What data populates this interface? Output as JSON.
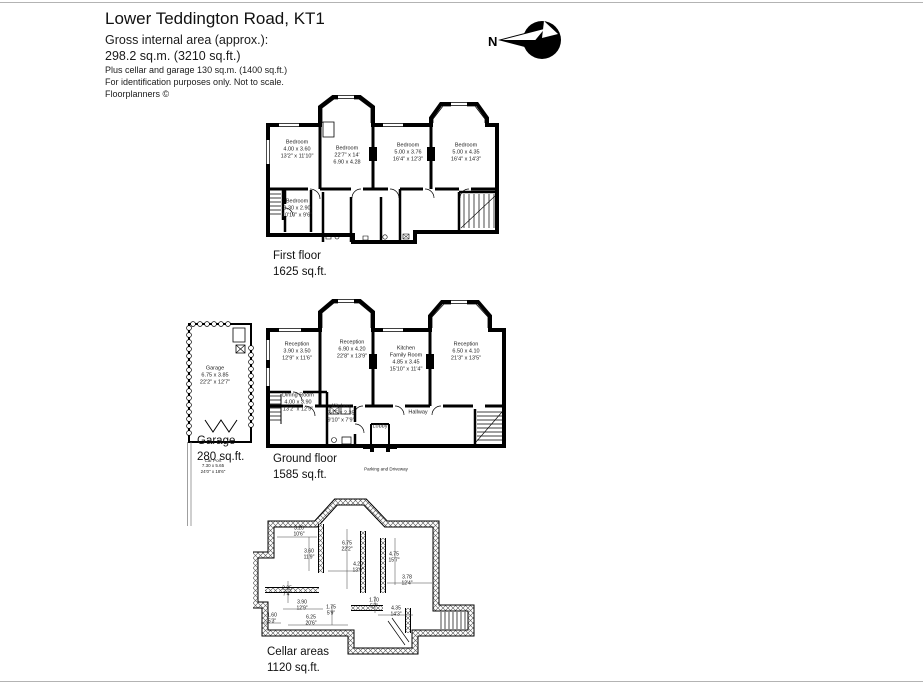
{
  "header": {
    "title": "Lower Teddington Road, KT1",
    "subtitle": "Gross internal area (approx.):",
    "area": "298.2 sq.m. (3210 sq.ft.)",
    "note_extra": "Plus cellar and garage 130 sq.m. (1400 sq.ft.)",
    "note_id": "For identification purposes only. Not to scale.",
    "note_brand": "Floorplanners ©"
  },
  "compass": {
    "label": "N"
  },
  "first_floor": {
    "label": "First floor",
    "area": "1625 sq.ft.",
    "rooms": [
      {
        "name": "Bedroom",
        "dim1": "4.00 x 3.60",
        "dim2": "13'2\" x 11'10\""
      },
      {
        "name": "Bedroom",
        "dim1": "22'7\" x 14'",
        "dim2": "6.90 x 4.28"
      },
      {
        "name": "Bedroom",
        "dim1": "5.00 x 3.76",
        "dim2": "16'4\" x 12'3\""
      },
      {
        "name": "Bedroom",
        "dim1": "5.00 x 4.35",
        "dim2": "16'4\" x 14'3\""
      },
      {
        "name": "Bedroom",
        "dim1": "3.30 x 2.90",
        "dim2": "10'10\" x 9'6\""
      }
    ]
  },
  "ground_floor": {
    "label": "Ground floor",
    "area": "1585 sq.ft.",
    "rooms": [
      {
        "name": "Reception",
        "dim1": "3.90 x 3.50",
        "dim2": "12'9\" x 11'6\""
      },
      {
        "name": "Reception",
        "dim1": "6.90 x 4.20",
        "dim2": "22'8\" x 13'9\""
      },
      {
        "name": "Kitchen Family Room",
        "dim1": "4.85 x 3.45",
        "dim2": "15'10\" x 11'4\""
      },
      {
        "name": "Reception",
        "dim1": "6.50 x 4.10",
        "dim2": "21'3\" x 13'5\""
      },
      {
        "name": "Dining Room",
        "dim1": "4.00 x 3.90",
        "dim2": "13'2\" x 12'9\""
      },
      {
        "name": "Kitchen",
        "dim1": "2.75 x 2.35",
        "dim2": "9'10\" x 7'9\""
      }
    ],
    "hallway": "Hallway",
    "lobby": "Lobby",
    "parking": "Parking and Driveway"
  },
  "garage": {
    "label": "Garage",
    "area": "280 sq.ft.",
    "room": {
      "name": "Garage",
      "dim1": "6.75 x 3.85",
      "dim2": "22'2\" x 12'7\""
    },
    "carport": {
      "name": "Car Port",
      "dim1": "7.30 x 5.65",
      "dim2": "24'0\" x 18'6\""
    }
  },
  "cellar": {
    "label": "Cellar areas",
    "area": "1120 sq.ft.",
    "dims": [
      {
        "m": "3.20",
        "i": "10'6\""
      },
      {
        "m": "3.60",
        "i": "11'9\""
      },
      {
        "m": "6.75",
        "i": "22'2\""
      },
      {
        "m": "4.20",
        "i": "13'9\""
      },
      {
        "m": "4.75",
        "i": "15'7\""
      },
      {
        "m": "3.78",
        "i": "12'4\""
      },
      {
        "m": "2.25",
        "i": "7'4\""
      },
      {
        "m": "3.90",
        "i": "12'9\""
      },
      {
        "m": "1.75",
        "i": "5'9\""
      },
      {
        "m": "1.60",
        "i": "5'3\""
      },
      {
        "m": "6.25",
        "i": "20'6\""
      },
      {
        "m": "1.70",
        "i": "5'7\""
      },
      {
        "m": "4.35",
        "i": "14'3\""
      }
    ]
  }
}
